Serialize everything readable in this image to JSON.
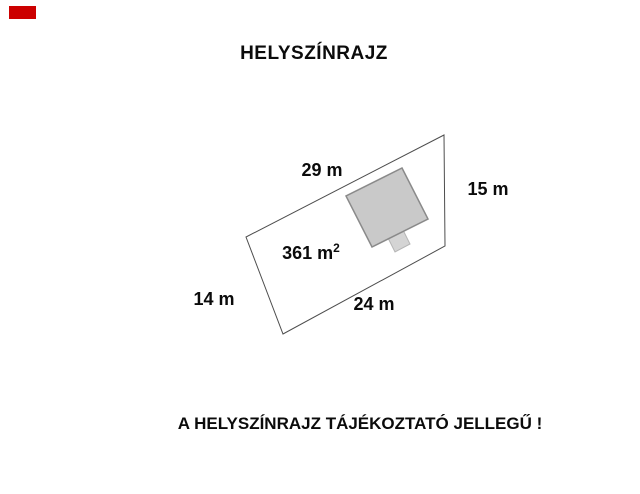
{
  "title": "HELYSZÍNRAJZ",
  "watermark": {
    "color": "#cc0000"
  },
  "plan": {
    "area": {
      "value": "361 m",
      "superscript": "2"
    },
    "dimensions": {
      "top": "29 m",
      "right": "15 m",
      "bottom": "24 m",
      "left": "14 m"
    },
    "colors": {
      "parcel_outline": "#4d4d4d",
      "parcel_fill": "none",
      "building_fill": "#c9c9c9",
      "building_stroke": "#8a8a8a",
      "annex_fill": "#d4d4d4",
      "annex_stroke": "#b5b5b5"
    }
  },
  "disclaimer": "A HELYSZÍNRAJZ TÁJÉKOZTATÓ JELLEGŰ !"
}
